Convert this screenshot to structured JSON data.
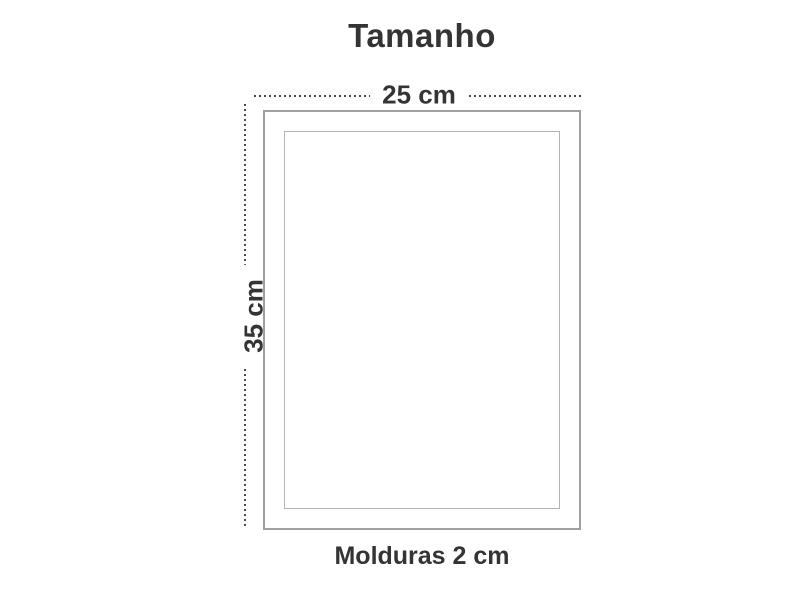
{
  "title": "Tamanho",
  "diagram": {
    "width_label": "25 cm",
    "height_label": "35 cm",
    "caption": "Molduras 2 cm"
  },
  "colors": {
    "text": "#343434",
    "frame_border": "#9f9f9f",
    "inner_border": "#b3b3b3",
    "dotted_line": "#4a4a4a",
    "background": "#ffffff"
  }
}
